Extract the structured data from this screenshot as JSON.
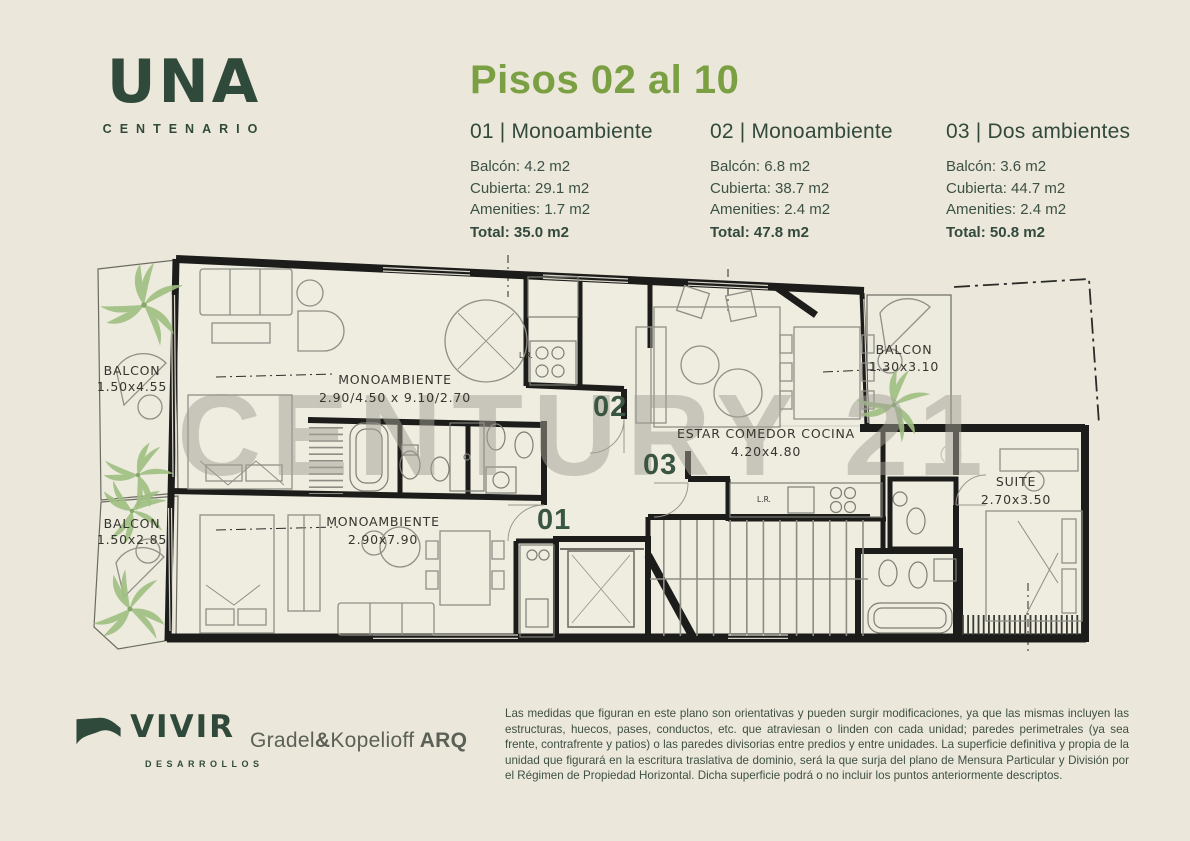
{
  "brand": {
    "name": "UNA",
    "subname": "CENTENARIO"
  },
  "header": {
    "title": "Pisos 02 al 10"
  },
  "units": [
    {
      "label": "01 | Monoambiente",
      "rows": [
        "Balcón: 4.2 m2",
        "Cubierta: 29.1 m2",
        "Amenities:  1.7 m2"
      ],
      "total": "Total: 35.0 m2"
    },
    {
      "label": "02 | Monoambiente",
      "rows": [
        "Balcón: 6.8 m2",
        "Cubierta: 38.7 m2",
        "Amenities:  2.4 m2"
      ],
      "total": "Total: 47.8 m2"
    },
    {
      "label": "03 | Dos ambientes",
      "rows": [
        "Balcón: 3.6 m2",
        "Cubierta: 44.7 m2",
        "Amenities:  2.4 m2"
      ],
      "total": "Total: 50.8 m2"
    }
  ],
  "plan": {
    "watermark": "CENTURY 21",
    "registered": "®",
    "labels": {
      "balcony_top_left": {
        "line1": "BALCON",
        "line2": "1.50x4.55"
      },
      "balcony_bottom_left": {
        "line1": "BALCON",
        "line2": "1.50x2.85"
      },
      "mono_top": {
        "line1": "MONOAMBIENTE",
        "line2": "2.90/4.50  x  9.10/2.70"
      },
      "mono_bottom": {
        "line1": "MONOAMBIENTE",
        "line2": "2.90x7.90"
      },
      "estar": {
        "line1": "ESTAR  COMEDOR  COCINA",
        "line2": "4.20x4.80"
      },
      "balcony_right": {
        "line1": "BALCON",
        "line2": "1.30x3.10"
      },
      "suite": {
        "line1": "SUITE",
        "line2": "2.70x3.50"
      },
      "lr1": "L.R.",
      "lr2": "L.R."
    },
    "markers": {
      "m01": "01",
      "m02": "02",
      "m03": "03"
    }
  },
  "footer": {
    "developer": {
      "name": "VIVIR",
      "subname": "DESARROLLOS"
    },
    "architect": {
      "p1": "Gradel",
      "amp": "&",
      "p2": "Kopelioff",
      "p3": " ARQ"
    },
    "disclaimer": "Las medidas que figuran en este plano son orientativas y pueden surgir modificaciones, ya que las mismas incluyen las estructuras, huecos, pases, conductos, etc. que atraviesan o linden con cada unidad; paredes perimetrales (ya sea frente, contrafrente y patios) o las paredes divisorias entre predios y entre unidades. La superficie definitiva y propia de la unidad que figurará en la escritura traslativa de dominio, será la que surja del plano de Mensura Particular y División por el Régimen de Propiedad Horizontal. Dicha superficie podrá o no incluir los puntos anteriormente descriptos."
  },
  "colors": {
    "background": "#ebe7da",
    "accent_green": "#7ba044",
    "dark_green": "#2f4a3b",
    "text_green": "#3c5145",
    "wall_black": "#1c1c1a",
    "watermark_gray": "#a3a196",
    "palm_green": "#9fbf82"
  }
}
